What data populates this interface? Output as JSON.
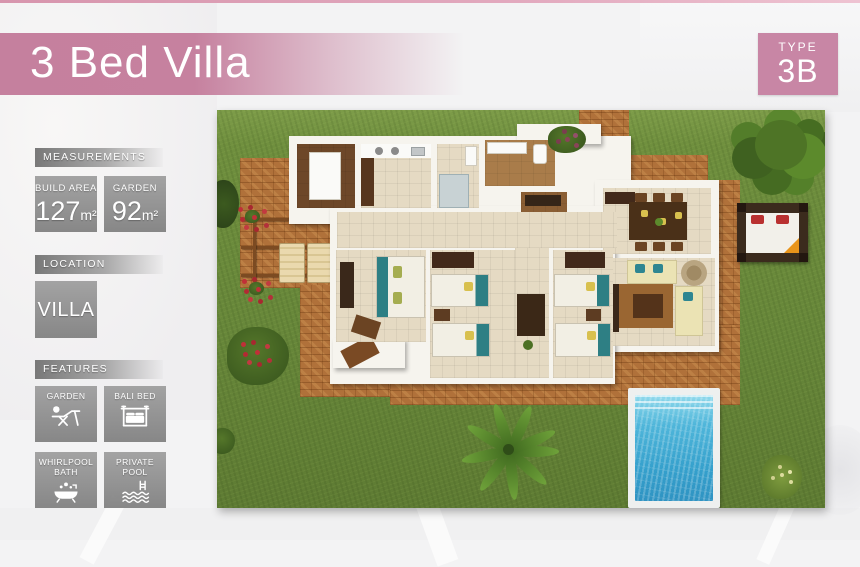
{
  "header": {
    "title": "3 Bed Villa"
  },
  "type_badge": {
    "label": "TYPE",
    "value": "3B"
  },
  "sidebar": {
    "measurements": {
      "heading": "MEASUREMENTS",
      "stats": [
        {
          "label": "BUILD AREA",
          "value": "127",
          "unit": "m²"
        },
        {
          "label": "GARDEN",
          "value": "92",
          "unit": "m²"
        }
      ]
    },
    "location": {
      "heading": "LOCATION",
      "value": "VILLA"
    },
    "features": {
      "heading": "FEATURES",
      "items": [
        {
          "label": "GARDEN",
          "icon": "garden-lounger-icon"
        },
        {
          "label": "BALI BED",
          "icon": "bali-bed-icon"
        },
        {
          "label": "WHIRLPOOL BATH",
          "icon": "whirlpool-bath-icon"
        },
        {
          "label": "PRIVATE POOL",
          "icon": "private-pool-icon"
        }
      ]
    }
  },
  "floorplan": {
    "type": "3d-aerial-villa-plan",
    "elements": [
      "lawn",
      "brick patio",
      "pergola terrace",
      "sun loungers",
      "utility room",
      "kitchen",
      "bathrooms",
      "master bedroom",
      "twin bedroom",
      "twin bedroom",
      "dining room",
      "living room",
      "swimming pool",
      "bali bed",
      "tree",
      "palm tree",
      "flower bushes"
    ],
    "colors": {
      "banner_pink": "#c5809e",
      "badge_pink": "#c886a5",
      "lawn_green": "#6a8b3a",
      "brick_terracotta": "#b0713a",
      "pool_blue": "#45b4d8",
      "floor_tan": "#e5dac3",
      "wall_white": "#f6f4ee",
      "accent_teal": "#2e7f84",
      "wood_dark": "#4a2f1d"
    }
  }
}
